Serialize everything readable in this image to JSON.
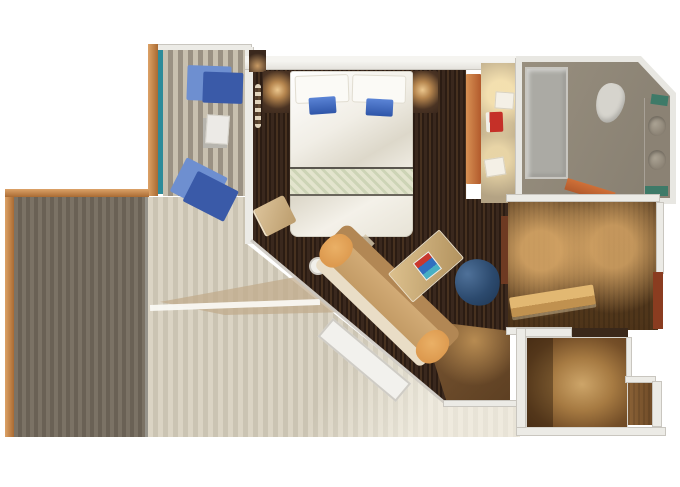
{
  "title": "Cruise ship suite floor plan, top-down 3D render, no text labels",
  "palette": {
    "white_bg": "#ffffff",
    "orange_rail": "#c98c50",
    "orange_rail_dark": "#a96a33",
    "teal_glass": "#2e8b99",
    "plank_mix_a": "#c8c0af",
    "plank_mix_b": "#9a9183",
    "plank_gray_a": "#7b7265",
    "plank_gray_b": "#6a6155",
    "plank_light_a": "#dbd4c4",
    "plank_light_b": "#cbc4b3",
    "deck_shadow": "#c0ab8a",
    "wall_light": "#ecebe6",
    "wall_edge": "#c9c6bf",
    "floor_dark_a": "#3a281d",
    "floor_dark_b": "#2b1c13",
    "floor_dark_c": "#47311f",
    "brown_room": "#5f4325",
    "brown_room_dark": "#4e3419",
    "hall_brown_mid": "#a67a42",
    "hall_brown_deep": "#63401f",
    "bath_wall": "#e8e7e2",
    "bath_floor_a": "#988f7f",
    "bath_floor_b": "#867e70",
    "bath_fixture": "#abaaa4",
    "teal_accent": "#3e7a68",
    "closet_tan": "#b4a384",
    "runner_a": "#e3e4cd",
    "runner_b": "#cdd4b6",
    "pillow_blue": "#3f6dc7",
    "lounger_light": "#6e8fd0",
    "lounger_dark": "#3a5aa8",
    "sofa_back": "#b28754",
    "sofa_seat": "#c29a64",
    "sofa_front": "#e9ddc6",
    "cushion_orange": "#dd9a4f",
    "chair_navy": "#2c4a6e",
    "table_tan": "#b3935f",
    "decor_red": "#c8372e",
    "decor_blue": "#2f6fc0",
    "door_orange": "#b25a2c",
    "door_red": "#8a3c20",
    "door_maroon": "#6e3a22",
    "lintel": "#3a281a",
    "red_chair": "#c53028"
  },
  "rooms": [
    {
      "id": "wraparound-balcony",
      "features": [
        "orange wood railing",
        "two-tone teak plank decking",
        "teal glass divider",
        "two blue sun loungers",
        "small side table"
      ]
    },
    {
      "id": "bedroom",
      "features": [
        "king bed with white and blue pillows",
        "patterned bed runner",
        "two lit nightstands",
        "curtain",
        "ottoman at foot"
      ]
    },
    {
      "id": "living-area",
      "features": [
        "diagonal tan sofa with orange bolsters",
        "angled coffee table with red/blue decor",
        "navy tub chair",
        "round white side table",
        "angled picture window to balcony"
      ]
    },
    {
      "id": "vanity-corridor",
      "features": [
        "orange wardrobe",
        "red vanity chair",
        "two ceiling light fixtures"
      ]
    },
    {
      "id": "bathroom",
      "features": [
        "shower stall",
        "toilet",
        "twin sinks on counter",
        "teal towels",
        "angled outer wall",
        "orange door"
      ]
    },
    {
      "id": "dressing-room",
      "features": [
        "two warm downlights",
        "tan bench",
        "maroon door panels"
      ]
    },
    {
      "id": "entry-hall",
      "features": [
        "L-shaped floor",
        "warm ceiling light glow",
        "dark lintel"
      ]
    }
  ]
}
